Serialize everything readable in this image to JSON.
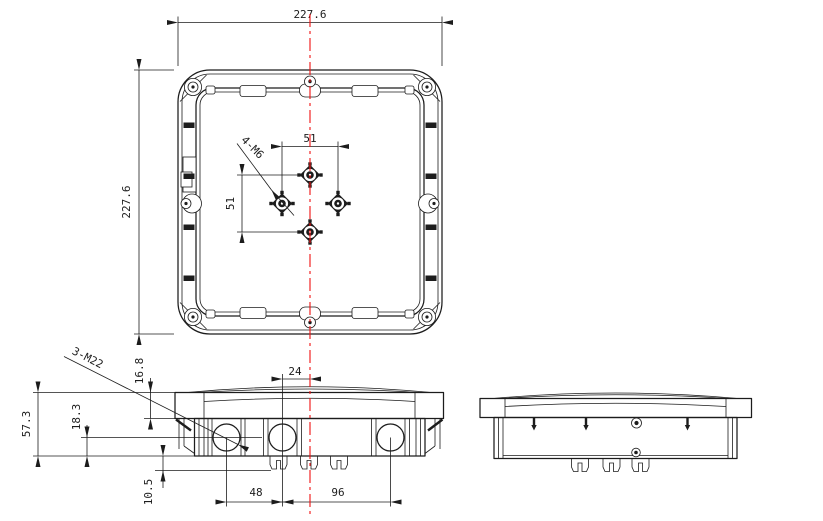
{
  "drawing": {
    "colors": {
      "line": "#1c1c1c",
      "centerline": "#f01010"
    },
    "top_view": {
      "width_dim": "227.6",
      "height_dim": "227.6",
      "boss_spacing_horizontal": "51",
      "boss_spacing_vertical": "51",
      "boss_holes_label": "4-M6"
    },
    "front_view": {
      "glands_label": "3-M22",
      "total_height": "57.3",
      "gland_center_height": "18.3",
      "lid_flange_height": "16.8",
      "clip_height": "10.5",
      "gland_to_center": "24",
      "gland_pitch_left": "48",
      "gland_pitch_right": "96"
    }
  }
}
